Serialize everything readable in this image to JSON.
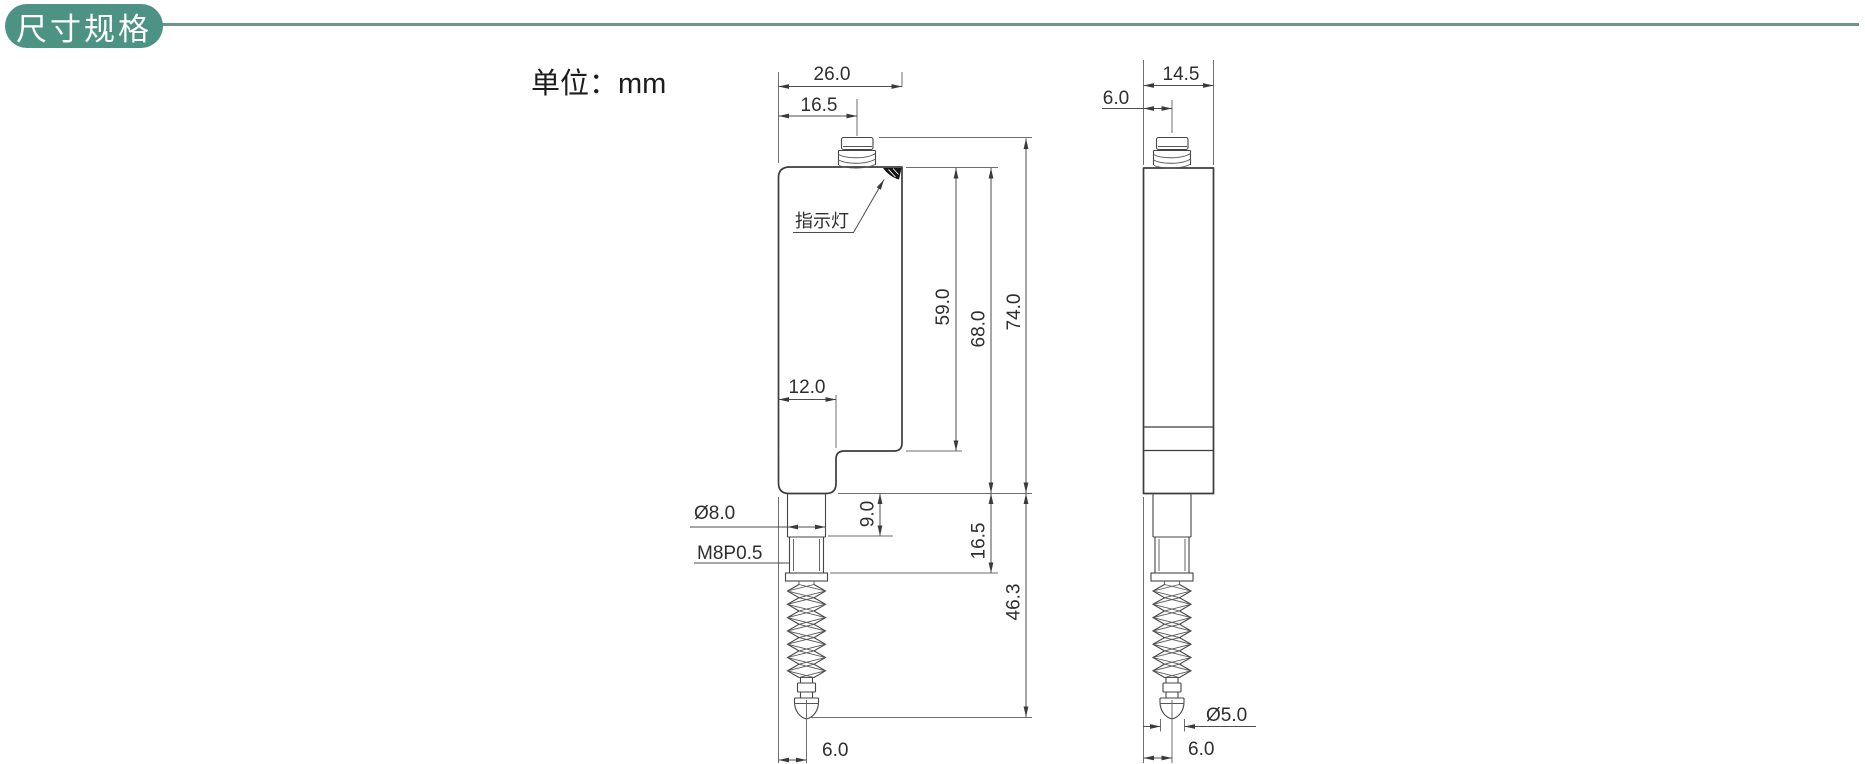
{
  "header": {
    "badge": "尺寸规格",
    "accent_color": "#4d9383",
    "divider_color": "#6b968b"
  },
  "unit_label": "单位：mm",
  "front_view": {
    "indicator_label": "指示灯",
    "dim_top_width": "26.0",
    "dim_top_offset": "16.5",
    "dim_upper_height": "59.0",
    "dim_body_height": "68.0",
    "dim_total_height": "74.0",
    "dim_lower_width": "12.0",
    "dim_stem_diameter": "Ø8.0",
    "dim_thread_spec": "M8P0.5",
    "dim_stem_length": "9.0",
    "dim_thread_length": "16.5",
    "dim_probe_length": "46.3",
    "dim_tip_offset": "6.0"
  },
  "side_view": {
    "dim_width": "14.5",
    "dim_connector_offset": "6.0",
    "dim_tip_diameter": "Ø5.0",
    "dim_tip_offset": "6.0"
  },
  "colors": {
    "outline": "#3c3c3c",
    "dimension": "#4d4d4d",
    "text": "#2e2e2e"
  }
}
